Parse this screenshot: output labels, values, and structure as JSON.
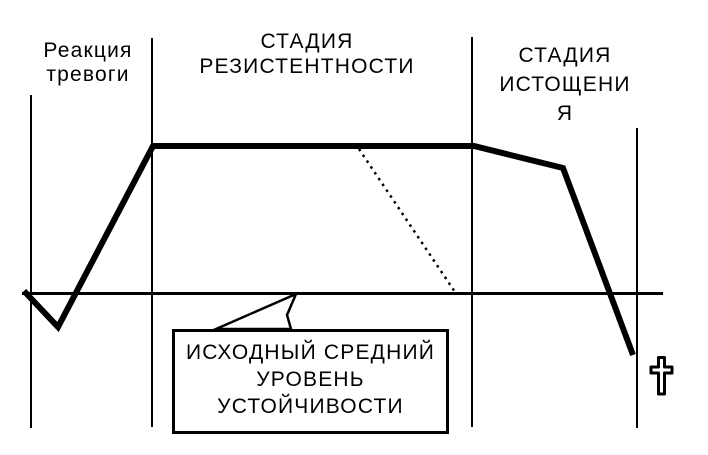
{
  "canvas": {
    "width": 708,
    "height": 455,
    "bg": "#ffffff",
    "ink": "#000000"
  },
  "labels": {
    "alarm": {
      "lines": [
        "Реакция",
        "тревоги"
      ]
    },
    "resistance": {
      "lines": [
        "СТАДИЯ",
        "РЕЗИСТЕНТНОСТИ"
      ]
    },
    "exhaustion": {
      "lines": [
        "СТАДИЯ",
        "ИСТОЩЕНИ",
        "Я"
      ]
    },
    "callout": {
      "lines": [
        "ИСХОДНЫЙ СРЕДНИЙ",
        "УРОВЕНЬ",
        "УСТОЙЧИВОСТИ"
      ]
    }
  },
  "icons": {
    "death_cross": "latin-cross"
  },
  "geometry": {
    "lines": [
      {
        "name": "left-axis-line",
        "x1": 31,
        "y1": 95,
        "x2": 31,
        "y2": 428,
        "w": 2
      },
      {
        "name": "alarm-resistance-divider",
        "x1": 152,
        "y1": 38,
        "x2": 152,
        "y2": 427,
        "w": 2
      },
      {
        "name": "resistance-exhaustion-divider",
        "x1": 472,
        "y1": 37,
        "x2": 472,
        "y2": 427,
        "w": 2
      },
      {
        "name": "right-time-line",
        "x1": 637,
        "y1": 128,
        "x2": 637,
        "y2": 428,
        "w": 2
      },
      {
        "name": "baseline",
        "x1": 22,
        "y1": 293.5,
        "x2": 663,
        "y2": 293.5,
        "w": 3
      },
      {
        "name": "projected-decline-dotted",
        "x1": 359,
        "y1": 149,
        "x2": 455,
        "y2": 292,
        "w": 2.5,
        "dash": "2.5 4.5"
      }
    ],
    "shapes": [
      {
        "name": "callout-pointer",
        "type": "polygon",
        "points": "296,294 216,329 291,329 287,315",
        "fill": "#ffffff",
        "w": 2.5
      },
      {
        "name": "resistance-curve",
        "type": "polyline",
        "points": "24,291 58,327 153,146 474,146 563,168 633,355",
        "fill": "none",
        "w": 6
      }
    ]
  },
  "chart_data": {
    "type": "line",
    "title": "",
    "xlabel": "",
    "ylabel": "",
    "grid": false,
    "legend": false,
    "stages": [
      {
        "label": "Реакция тревоги",
        "x_range_px": [
          31,
          152
        ]
      },
      {
        "label": "СТАДИЯ РЕЗИСТЕНТНОСТИ",
        "x_range_px": [
          152,
          472
        ]
      },
      {
        "label": "СТАДИЯ ИСТОЩЕНИЯ",
        "x_range_px": [
          472,
          637
        ]
      }
    ],
    "baseline": {
      "label": "ИСХОДНЫЙ СРЕДНИЙ УРОВЕНЬ УСТОЙЧИВОСТИ",
      "value": 0
    },
    "series": [
      {
        "name": "уровень устойчивости",
        "style": "solid-bold",
        "points_rel": [
          [
            0.0,
            0.0
          ],
          [
            0.056,
            -0.23
          ],
          [
            0.212,
            1.0
          ],
          [
            0.739,
            1.0
          ],
          [
            0.885,
            0.85
          ],
          [
            1.0,
            -0.42
          ]
        ]
      },
      {
        "name": "проекция снижения",
        "style": "dotted",
        "points_rel": [
          [
            0.55,
            0.98
          ],
          [
            0.708,
            0.0
          ]
        ]
      }
    ],
    "end_marker": "latin-cross (death)"
  }
}
